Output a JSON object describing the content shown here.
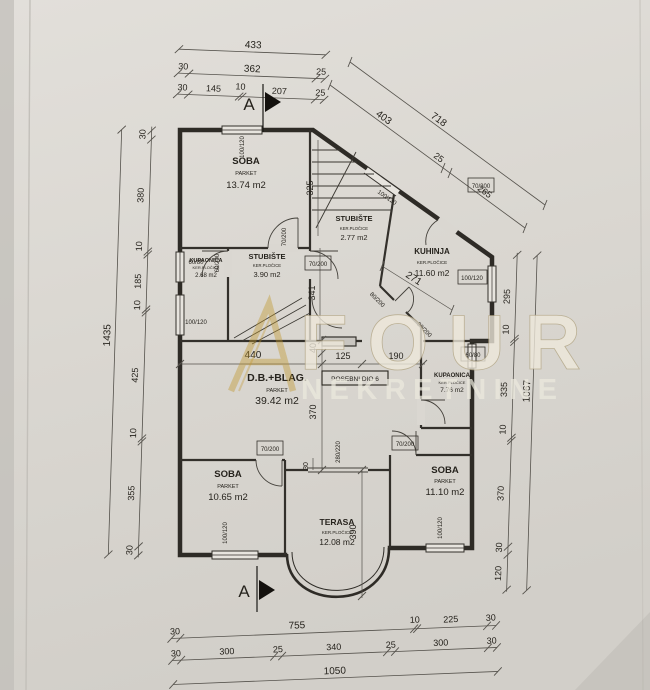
{
  "watermark": {
    "brand": "FOUR",
    "brand_sub": "NEKRETNINE"
  },
  "section": {
    "top": "A",
    "bottom": "A"
  },
  "special_unit": "POSEBNI DIO 6",
  "rooms": [
    {
      "name": "SOBA",
      "finish": "PARKET",
      "area": "13.74 m2"
    },
    {
      "name": "KUPAONICA",
      "finish": "KER.PLOČICE",
      "area": "2.68 m2"
    },
    {
      "name": "STUBIŠTE",
      "finish": "KER.PLOČICE",
      "area": "3.90 m2"
    },
    {
      "name": "STUBIŠTE",
      "finish": "KER.PLOČICE",
      "area": "2.77 m2"
    },
    {
      "name": "KUHINJA",
      "finish": "KER.PLOČICE",
      "area": "11.60 m2"
    },
    {
      "name": "D.B.+BLAG.",
      "finish": "PARKET",
      "area": "39.42 m2"
    },
    {
      "name": "KUPAONICA",
      "finish": "KER.PLOČICE",
      "area": "7.76 m2"
    },
    {
      "name": "SOBA",
      "finish": "PARKET",
      "area": "10.65 m2"
    },
    {
      "name": "SOBA",
      "finish": "PARKET",
      "area": "11.10 m2"
    },
    {
      "name": "TERASA",
      "finish": "KER.PLOČICE",
      "area": "12.08 m2"
    }
  ],
  "openings": [
    "100/120",
    "60/80",
    "60/200",
    "70/200",
    "70/200",
    "100/120",
    "100/120",
    "70/200",
    "80/200",
    "80/200",
    "100/120",
    "60/80",
    "70/200",
    "70/200",
    "280/220",
    "100/120",
    "100/120"
  ],
  "dims": {
    "top_total": "433",
    "top_row2": [
      "30",
      "362",
      "25"
    ],
    "top_row3": [
      "30",
      "145",
      "10",
      "207",
      "25"
    ],
    "diag_total": "718",
    "diag_parts": [
      "403",
      "25",
      "265"
    ],
    "left_total": "1435",
    "left_parts": [
      "30",
      "380",
      "10",
      "185",
      "10",
      "425",
      "10",
      "355",
      "30"
    ],
    "right_total": "1067",
    "right_parts": [
      "295",
      "10",
      "335",
      "10",
      "370",
      "30",
      "120"
    ],
    "bottom_row1": [
      "30",
      "755",
      "10",
      "225",
      "30"
    ],
    "bottom_row2": [
      "30",
      "300",
      "25",
      "340",
      "25",
      "300",
      "30"
    ],
    "bottom_total": "1050",
    "interior": {
      "stair": "325",
      "stub": "341",
      "kitchen": "271",
      "db_w": "440",
      "open1": "125",
      "open2": "190",
      "beam": "40",
      "db_h": "370",
      "terrace": "390",
      "terr_off": "30"
    }
  }
}
